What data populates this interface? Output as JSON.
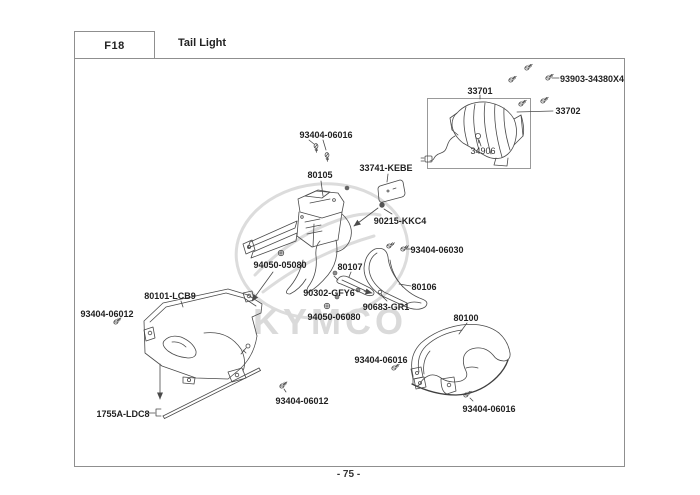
{
  "header": {
    "code": "F18",
    "title": "Tail Light"
  },
  "footer": {
    "page_number": "- 75 -"
  },
  "watermark": {
    "text": "KYMCO"
  },
  "colors": {
    "line": "#4a4a4a",
    "label_text": "#222222",
    "border": "#8f8f8f",
    "watermark": "#dadada",
    "background": "#ffffff"
  },
  "part_labels": {
    "p93903": "93903-34380X4",
    "p33701": "33701",
    "p33702": "33702",
    "p34906": "34906",
    "p93404_06016_top": "93404-06016",
    "p80105": "80105",
    "p33741": "33741-KEBE",
    "p90215": "90215-KKC4",
    "p94050_05080": "94050-05080",
    "p80107": "80107",
    "p90302": "90302-GFY6",
    "p93404_06030": "93404-06030",
    "p80106": "80106",
    "p90683": "90683-GR1",
    "p94050_06080": "94050-06080",
    "p80101": "80101-LCB9",
    "p93404_06012_left": "93404-06012",
    "p1755A": "1755A-LDC8",
    "p80100": "80100",
    "p93404_06016_mid": "93404-06016",
    "p93404_06012_bottom": "93404-06012",
    "p93404_06016_bottom": "93404-06016"
  }
}
